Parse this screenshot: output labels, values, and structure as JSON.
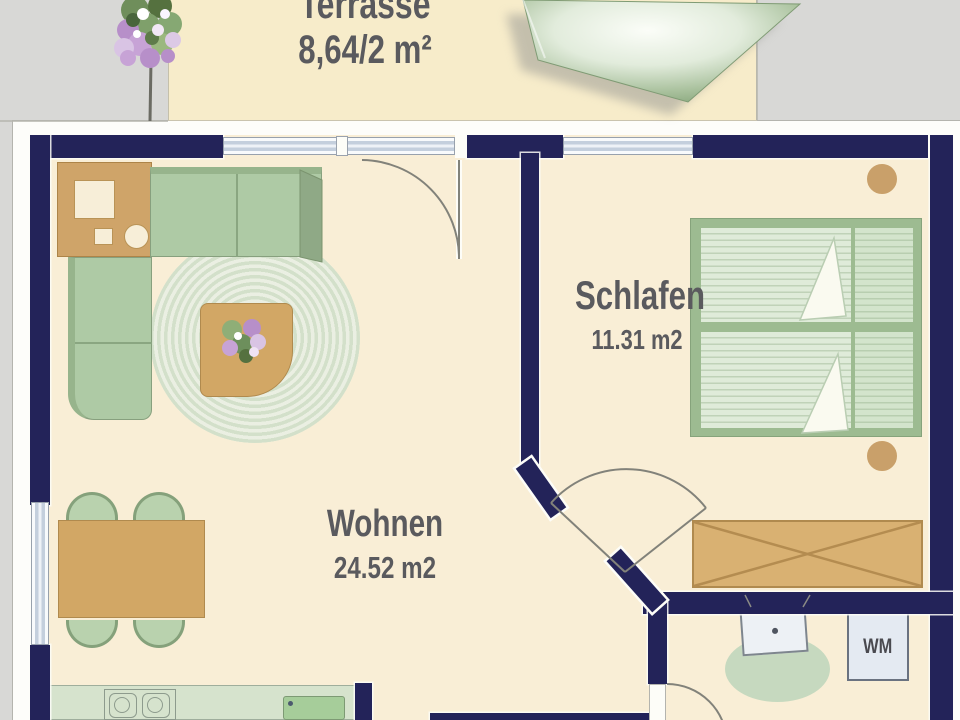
{
  "rooms": {
    "terrasse": {
      "name": "Terrasse",
      "area": "8,64/2 m²"
    },
    "schlafen": {
      "name": "Schlafen",
      "area": "11.31 m2"
    },
    "wohnen": {
      "name": "Wohnen",
      "area": "24.52 m2"
    }
  },
  "labels": {
    "washing_machine": "WM"
  },
  "colors": {
    "wall": "#232359",
    "floor": "#f9eed6",
    "terrace": "#f7ecca",
    "background": "#d8d8d6",
    "wood": "#d2a765",
    "sofa_green": "#aecaa5",
    "text": "#5a5a5e"
  }
}
